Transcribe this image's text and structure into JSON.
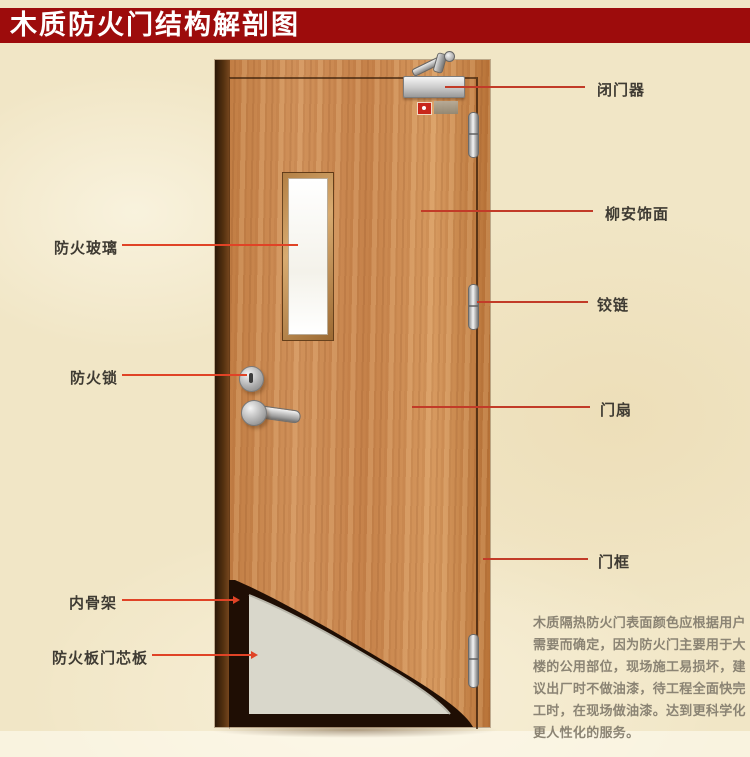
{
  "title": "木质防火门结构解剖图",
  "colors": {
    "banner": "#9d0c0c",
    "background": "#f1e6c6",
    "wood": "#d0915a",
    "leader": "#c23b28",
    "leader_bright": "#e04326",
    "label_text": "#3f3b33",
    "paragraph_text": "#8b8474"
  },
  "left_labels": [
    {
      "id": "fire-glass",
      "text": "防火玻璃"
    },
    {
      "id": "fire-lock",
      "text": "防火锁"
    },
    {
      "id": "inner-skeleton",
      "text": "内骨架"
    },
    {
      "id": "fire-board-core",
      "text": "防火板门芯板"
    }
  ],
  "right_labels": [
    {
      "id": "door-closer",
      "text": "闭门器"
    },
    {
      "id": "lauan-veneer",
      "text": "柳安饰面"
    },
    {
      "id": "hinge",
      "text": "铰链"
    },
    {
      "id": "door-leaf",
      "text": "门扇"
    },
    {
      "id": "door-frame",
      "text": "门框"
    }
  ],
  "description": {
    "lines": [
      "木质隔热防火门表面颜色应根据用户",
      "需要而确定，因为防火门主要用于大",
      "楼的公用部位，现场施工易损坏，建",
      "议出厂时不做油漆，待工程全面快完",
      "工时，在现场做油漆。达到更科学化",
      "更人性化的服务。"
    ]
  },
  "door_illustration": {
    "parts": [
      "door-closer-device",
      "closer-arm",
      "red-indicator",
      "gray-plate",
      "glass-window",
      "keyhole-escutcheon",
      "lever-handle",
      "hinge-top",
      "hinge-middle",
      "hinge-bottom",
      "left-frame-jamb",
      "door-leaf-panel",
      "cutaway-inner-skeleton",
      "cutaway-core-board"
    ]
  }
}
